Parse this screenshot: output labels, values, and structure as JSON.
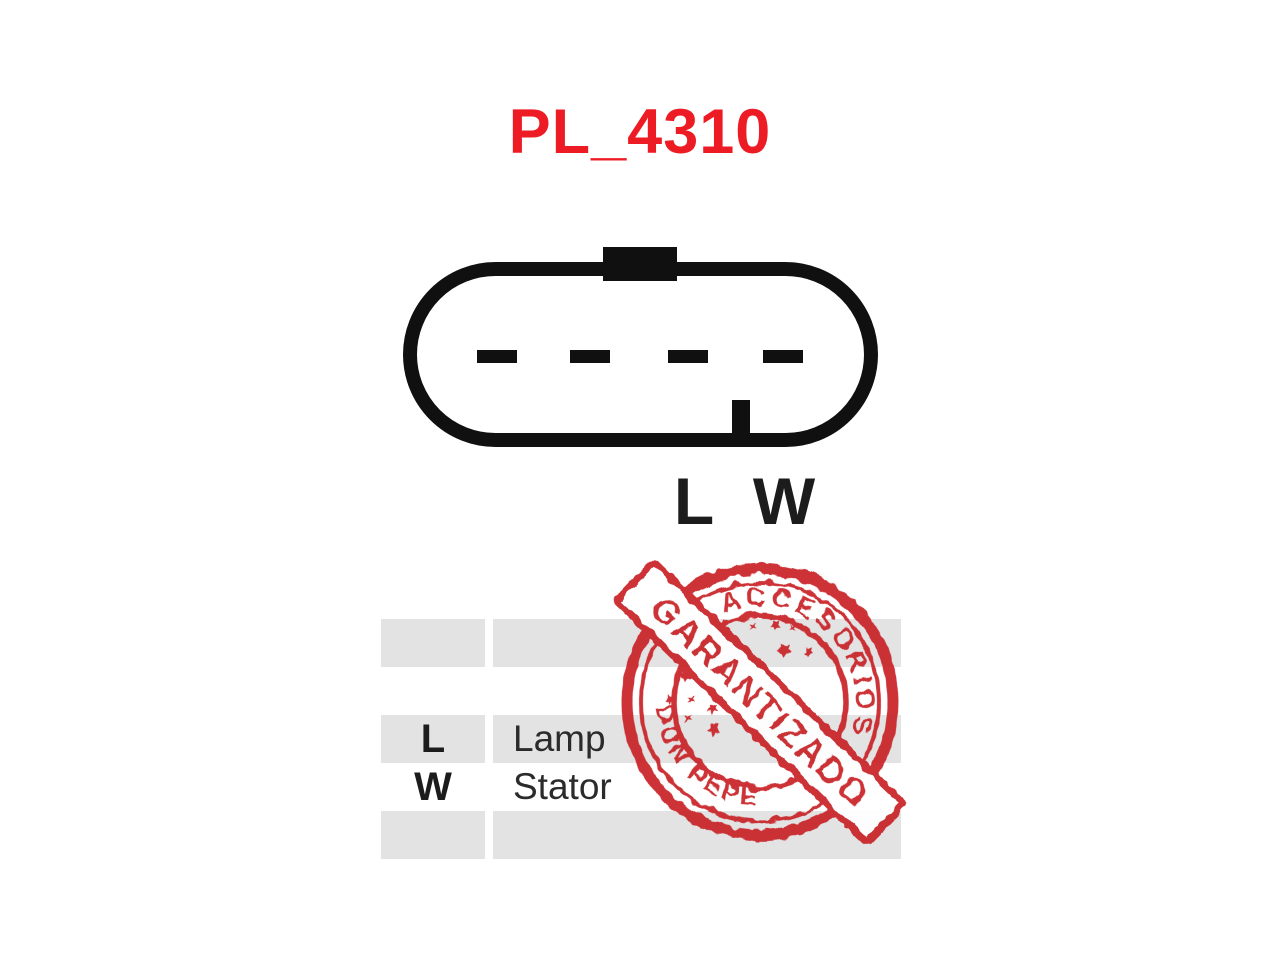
{
  "page": {
    "background": "#ffffff",
    "width": 1280,
    "height": 960
  },
  "title": {
    "text": "PL_4310",
    "color": "#ed1c24"
  },
  "connector": {
    "type": "4-pin oval plug, top keying tab, bottom index notch",
    "pin_count": 4,
    "outline_color": "#101010"
  },
  "pin_labels": [
    {
      "text": "L"
    },
    {
      "text": "W"
    }
  ],
  "table": {
    "row_color": "#e3e3e3",
    "rows": [
      {
        "pin": "",
        "desc": ""
      },
      {
        "pin": "",
        "desc": ""
      },
      {
        "pin": "L",
        "desc": "Lamp"
      },
      {
        "pin": "W",
        "desc": "Stator"
      },
      {
        "pin": "",
        "desc": ""
      }
    ]
  },
  "stamp": {
    "arc_top_text": "ACCESORIOS",
    "arc_bottom_text": "DON PEPE",
    "banner_text": "GARANTIZADO",
    "color": "#c9252c"
  }
}
